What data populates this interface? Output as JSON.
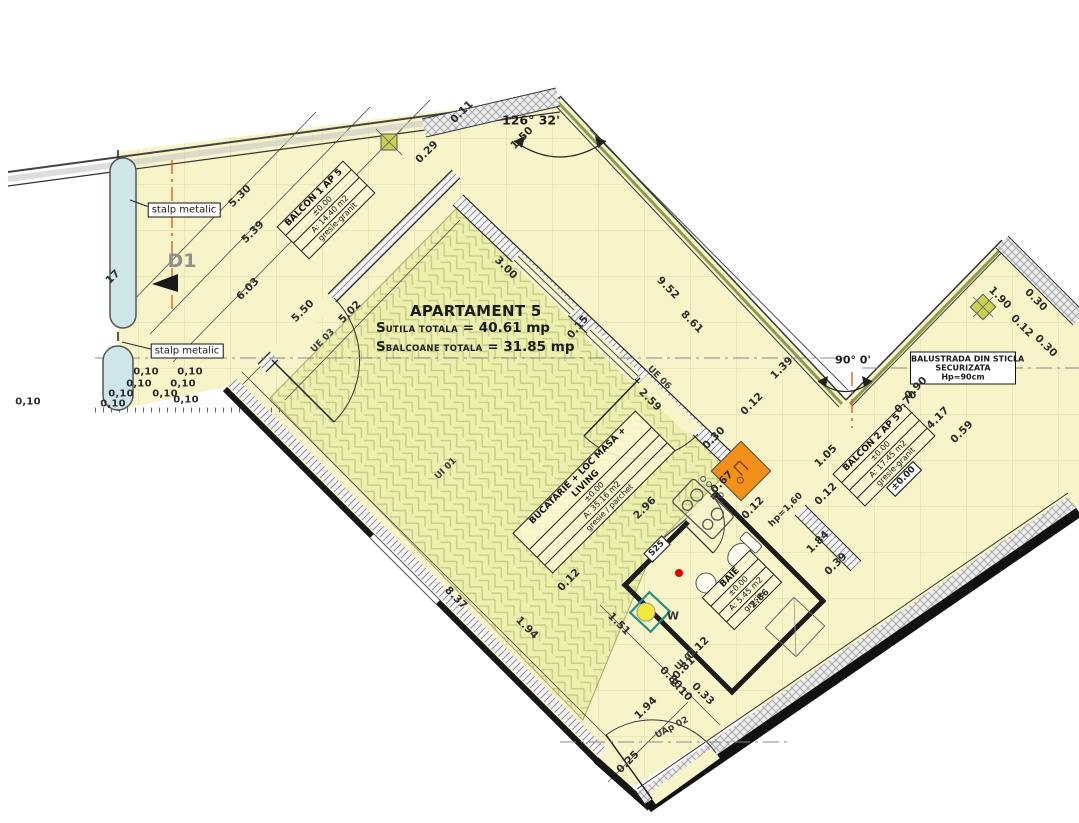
{
  "title_block": {
    "title": "APARTAMENT 5",
    "line1_prefix": "S",
    "line1_label": "UTILA TOTALA",
    "line1_value": "= 40.61 mp",
    "line2_prefix": "S",
    "line2_label": "BALCOANE TOTALA",
    "line2_value": "= 31.85 mp"
  },
  "rooms": [
    {
      "name": "BALCON 1 AP 5",
      "level": "±0.00",
      "area": "A: 14.40 m2",
      "finish": "gresie-granit"
    },
    {
      "name": "BUCATARIE + LOC MASA + LIVING",
      "level": "±0.00",
      "area": "A: 35.16 m2",
      "finish": "gresie / parchet"
    },
    {
      "name": "BAIE",
      "level": "±0.00",
      "area": "A: 5.45 m2",
      "finish": "gresie"
    },
    {
      "name": "BALCON 2 AP 5",
      "level": "±0.00",
      "area": "A: 17.45 m2",
      "finish": "gresie-granit"
    }
  ],
  "annotations": {
    "stalp_metalic_1": "stalp metalic",
    "stalp_metalic_2": "stalp metalic",
    "balustrada": {
      "line1": "BALUSTRADA DIN STICLA",
      "line2": "SECURIZATA",
      "line3": "Hp=90cm"
    },
    "angle_top": "126° 32'",
    "angle_right": "90° 0'",
    "level_box": "±0.00",
    "section_tag": "S25",
    "washer": "W",
    "detail_mark": "D1"
  },
  "door_window_tags": [
    {
      "t": "UE 03",
      "x": 323,
      "y": 341,
      "r": -45
    },
    {
      "t": "UI 01",
      "x": 446,
      "y": 469,
      "r": -45
    },
    {
      "t": "UE 06",
      "x": 659,
      "y": 378,
      "r": 45
    },
    {
      "t": "UI 02",
      "x": 686,
      "y": 660,
      "r": -45
    },
    {
      "t": "UAp 02",
      "x": 672,
      "y": 728,
      "r": -28
    }
  ],
  "dimensions": [
    {
      "t": "5.30",
      "x": 240,
      "y": 196,
      "r": -45
    },
    {
      "t": "5.39",
      "x": 253,
      "y": 232,
      "r": -45
    },
    {
      "t": "6.03",
      "x": 248,
      "y": 289,
      "r": -45
    },
    {
      "t": "5.50",
      "x": 303,
      "y": 311,
      "r": -45
    },
    {
      "t": "5.02",
      "x": 350,
      "y": 312,
      "r": -45
    },
    {
      "t": "3.00",
      "x": 506,
      "y": 268,
      "r": 45
    },
    {
      "t": "0.15",
      "x": 578,
      "y": 327,
      "r": -50
    },
    {
      "t": "9.52",
      "x": 668,
      "y": 288,
      "r": 45
    },
    {
      "t": "8.61",
      "x": 692,
      "y": 322,
      "r": 45
    },
    {
      "t": "2.59",
      "x": 650,
      "y": 400,
      "r": 45
    },
    {
      "t": "1.39",
      "x": 782,
      "y": 368,
      "r": -45
    },
    {
      "t": "0.12",
      "x": 752,
      "y": 404,
      "r": -45
    },
    {
      "t": "0.30",
      "x": 714,
      "y": 438,
      "r": -45
    },
    {
      "t": "0.67",
      "x": 722,
      "y": 482,
      "r": -45
    },
    {
      "t": "0.12",
      "x": 753,
      "y": 508,
      "r": -45
    },
    {
      "t": "hp=1,60",
      "x": 786,
      "y": 510,
      "r": -45,
      "s": 9
    },
    {
      "t": "2.96",
      "x": 645,
      "y": 508,
      "r": -45
    },
    {
      "t": "8.37",
      "x": 456,
      "y": 598,
      "r": 45
    },
    {
      "t": "1.94",
      "x": 527,
      "y": 628,
      "r": 45
    },
    {
      "t": "0.12",
      "x": 569,
      "y": 580,
      "r": -45
    },
    {
      "t": "1.51",
      "x": 619,
      "y": 624,
      "r": 45
    },
    {
      "t": "0.80",
      "x": 671,
      "y": 678,
      "r": 45
    },
    {
      "t": "2.10",
      "x": 681,
      "y": 690,
      "r": 45
    },
    {
      "t": "0.33",
      "x": 703,
      "y": 694,
      "r": 45
    },
    {
      "t": "0.12",
      "x": 698,
      "y": 648,
      "r": -45
    },
    {
      "t": "1.94",
      "x": 646,
      "y": 708,
      "r": -45
    },
    {
      "t": "0.25",
      "x": 628,
      "y": 762,
      "r": -45
    },
    {
      "t": "1.84",
      "x": 818,
      "y": 542,
      "r": -45
    },
    {
      "t": "0.39",
      "x": 836,
      "y": 564,
      "r": -45
    },
    {
      "t": "0.81",
      "x": 684,
      "y": 668,
      "r": -45
    },
    {
      "t": "2.86",
      "x": 760,
      "y": 599,
      "r": -45,
      "s": 9
    },
    {
      "t": "1.90",
      "x": 1000,
      "y": 298,
      "r": 45
    },
    {
      "t": "0.30",
      "x": 1036,
      "y": 300,
      "r": 45
    },
    {
      "t": "0.12",
      "x": 1022,
      "y": 326,
      "r": 45
    },
    {
      "t": "0.30",
      "x": 1046,
      "y": 346,
      "r": 45
    },
    {
      "t": "0.90",
      "x": 916,
      "y": 388,
      "r": -45
    },
    {
      "t": "0.70",
      "x": 906,
      "y": 402,
      "r": -45
    },
    {
      "t": "4.17",
      "x": 938,
      "y": 418,
      "r": -45
    },
    {
      "t": "0.59",
      "x": 962,
      "y": 432,
      "r": -45
    },
    {
      "t": "1.05",
      "x": 826,
      "y": 456,
      "r": -45
    },
    {
      "t": "0.12",
      "x": 826,
      "y": 494,
      "r": -45
    },
    {
      "t": "0.11",
      "x": 462,
      "y": 112,
      "r": -45
    },
    {
      "t": "1.50",
      "x": 522,
      "y": 138,
      "r": -45
    },
    {
      "t": "0.29",
      "x": 427,
      "y": 152,
      "r": -45
    },
    {
      "t": "17",
      "x": 113,
      "y": 277,
      "r": -45
    },
    {
      "t": "0,10",
      "x": 146,
      "y": 372,
      "r": 0,
      "s": 10
    },
    {
      "t": "0,10",
      "x": 190,
      "y": 372,
      "r": 0,
      "s": 10
    },
    {
      "t": "0,10",
      "x": 139,
      "y": 384,
      "r": 0,
      "s": 10
    },
    {
      "t": "0,10",
      "x": 183,
      "y": 384,
      "r": 0,
      "s": 10
    },
    {
      "t": "0,10",
      "x": 121,
      "y": 394,
      "r": 0,
      "s": 10
    },
    {
      "t": "0,10",
      "x": 165,
      "y": 394,
      "r": 0,
      "s": 10
    },
    {
      "t": "0,10",
      "x": 113,
      "y": 404,
      "r": 0,
      "s": 10
    },
    {
      "t": "0,10",
      "x": 186,
      "y": 400,
      "r": 0,
      "s": 10
    },
    {
      "t": "0,10",
      "x": 28,
      "y": 402,
      "r": 0,
      "s": 10
    }
  ],
  "colors": {
    "floor": "#f8f4c9",
    "living": "#ecefad",
    "orange_unit": "#f39019",
    "column_blue": "#cfe6e8",
    "boiler_yellow": "#f2e93a",
    "axis_red": "#e05010",
    "glass_green": "#8a9a50"
  }
}
